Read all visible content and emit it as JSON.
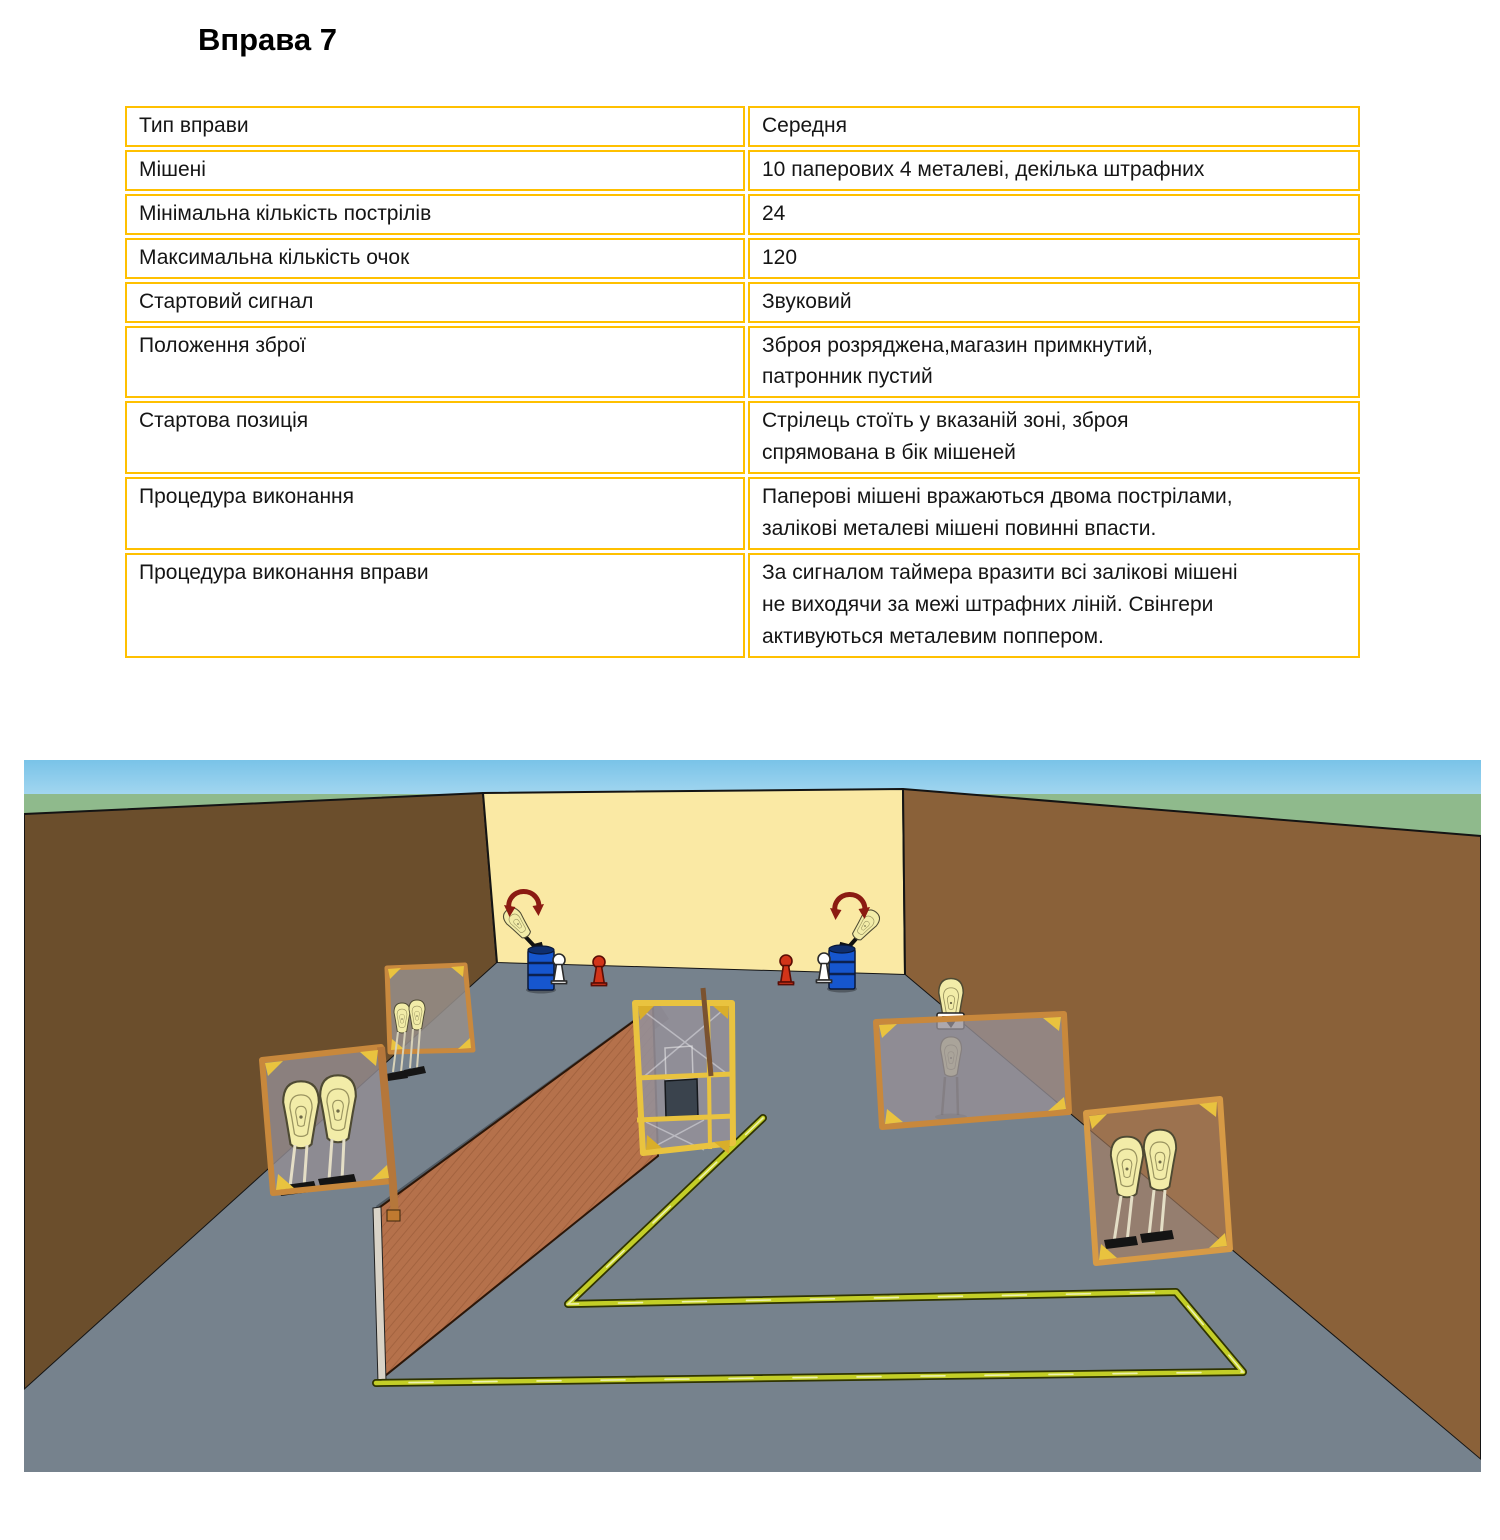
{
  "page": {
    "title": "Вправа 7"
  },
  "table": {
    "border_color": "#FFC000",
    "rows": [
      {
        "label": "Тип вправи",
        "value": "Середня"
      },
      {
        "label": "Мішені",
        "value": "10 паперових 4 металеві, декілька штрафних"
      },
      {
        "label": "Мінімальна кількість пострілів",
        "value": "24"
      },
      {
        "label": "Максимальна кількість очок",
        "value": "120"
      },
      {
        "label": "Стартовий сигнал",
        "value": "Звуковий"
      },
      {
        "label": "Положення  зброї",
        "value": "Зброя розряджена,магазин примкнутий,\nпатронник пустий"
      },
      {
        "label": "Стартова позиція",
        "value": "Стрілець стоїть у вказаній зоні, зброя\nспрямована в бік мішеней"
      },
      {
        "label": "Процедура виконання",
        "value": "Паперові мішені вражаються двома пострілами,\nзалікові металеві мішені повинні впасти."
      },
      {
        "label": "Процедура  виконання вправи",
        "value": "За сигналом таймера вразити всі залікові мішені\nне виходячи за межі штрафних ліній. Свінгери\nактивуються металевим поппером."
      }
    ]
  },
  "scene": {
    "kind": "stage-diagram-3d",
    "palette": {
      "sky_top": "#79C3E8",
      "sky_bottom": "#EAF7FD",
      "grass": "#8FBA8C",
      "wall_left": "#6B4E2C",
      "wall_back": "#FAE9A4",
      "wall_right": "#8A6139",
      "floor": "#76828D",
      "barrier_mesh": "#B5714B",
      "frame_yellow": "#E9C33F",
      "wood": "#C8883C",
      "penalty_line": "#C3CE27",
      "barrel_blue": "#1656CE",
      "popper_red": "#D23419",
      "popper_white": "#FFFFFF",
      "paper_target": "#F2ECA8",
      "swing_arrow": "#8B1B12"
    },
    "objects": [
      "left-swinger-barrel",
      "right-swinger-barrel",
      "left-white-popper",
      "left-red-popper",
      "right-white-popper",
      "right-red-popper",
      "upper-left-mesh-screen",
      "left-paper-target-stand",
      "center-port-wall",
      "diagonal-mesh-barrier",
      "right-swinger-stand",
      "far-right-paper-target-stand",
      "penalty-floor-lines"
    ]
  }
}
